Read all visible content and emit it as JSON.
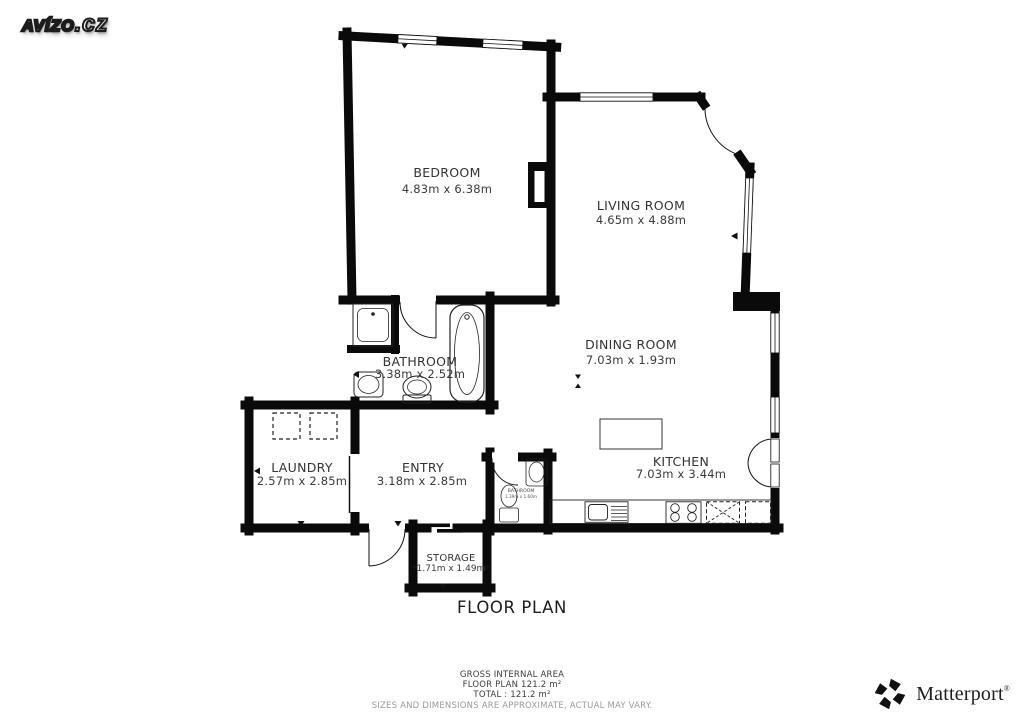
{
  "brand": {
    "name": "AVÍZO",
    "suffix": ".cz"
  },
  "floor_plan": {
    "title": "FLOOR PLAN",
    "rooms": [
      {
        "name": "BEDROOM",
        "dims": "4.83m x 6.38m"
      },
      {
        "name": "LIVING ROOM",
        "dims": "4.65m x 4.88m"
      },
      {
        "name": "DINING ROOM",
        "dims": "7.03m x 1.93m"
      },
      {
        "name": "BATHROOM",
        "dims": "3.38m x 2.52m"
      },
      {
        "name": "LAUNDRY",
        "dims": "2.57m x 2.85m"
      },
      {
        "name": "ENTRY",
        "dims": "3.18m x 2.85m"
      },
      {
        "name": "KITCHEN",
        "dims": "7.03m x 3.44m"
      },
      {
        "name": "STORAGE",
        "dims": "1.71m x 1.49m"
      },
      {
        "name": "BATHROOM",
        "dims": "1.39m x 1.60m"
      }
    ]
  },
  "footer": {
    "area_heading": "GROSS INTERNAL AREA",
    "area_line1": "FLOOR PLAN 121.2 m²",
    "area_line2": "TOTAL :  121.2 m²",
    "disclaimer": "SIZES AND DIMENSIONS ARE APPROXIMATE, ACTUAL MAY VARY."
  },
  "matterport": {
    "wordmark": "Matterport",
    "registered": "®"
  },
  "colors": {
    "wall": "#0a0a0a",
    "background": "#ffffff",
    "label": "#333333",
    "disclaimer": "#9a9a9a"
  }
}
